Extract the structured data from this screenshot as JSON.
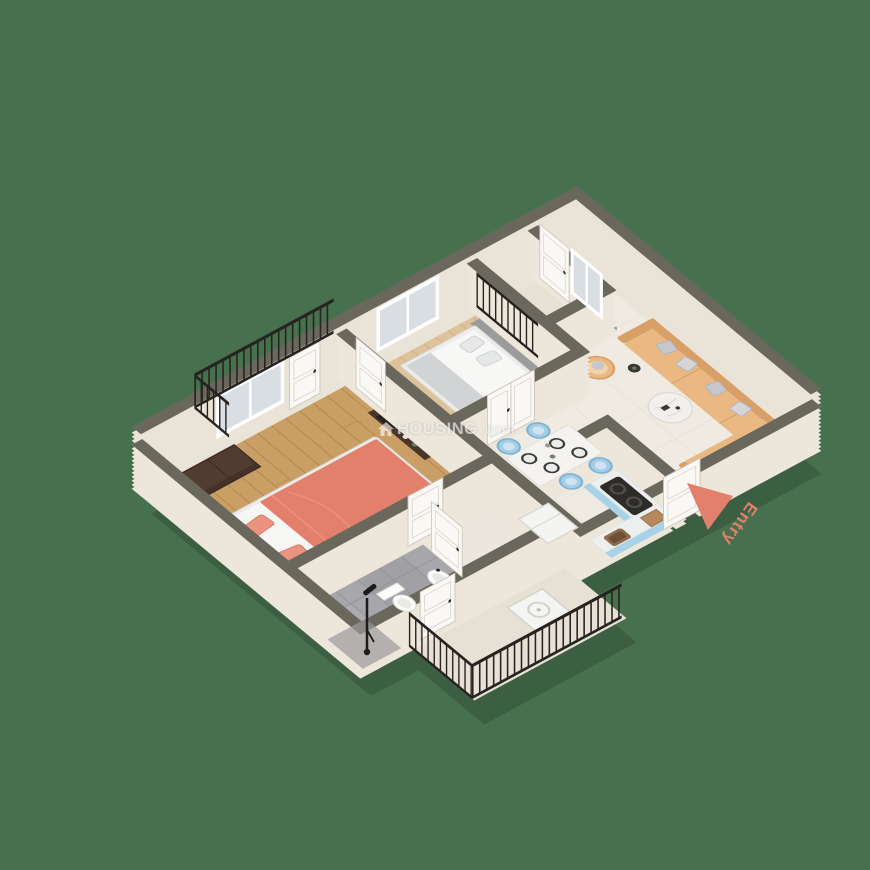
{
  "scene": {
    "description": "3D isometric render of an apartment floor plan on a green background",
    "background": "#47704E"
  },
  "entry": {
    "label": "Entry",
    "label_color": "#E4756B",
    "arrow_color": "#E8796C",
    "arrow_icon": "entry-arrow-icon"
  },
  "watermark": {
    "icon": "house-icon",
    "brand": "HOUSING",
    "tld": ".com"
  },
  "regions": [
    {
      "id": "master-bedroom",
      "floor": "wood"
    },
    {
      "id": "bedroom-2",
      "floor": "light-wood"
    },
    {
      "id": "living-room",
      "floor": "marble"
    },
    {
      "id": "dining-area",
      "floor": "marble"
    },
    {
      "id": "kitchen",
      "floor": "marble"
    },
    {
      "id": "bathroom",
      "floor": "grey-tile"
    },
    {
      "id": "hall",
      "floor": "cream"
    },
    {
      "id": "balcony-north",
      "floor": "cream"
    },
    {
      "id": "balcony-northeast",
      "floor": "cream"
    },
    {
      "id": "balcony-south",
      "floor": "cream"
    }
  ],
  "palette": {
    "bg": "#47704E",
    "wallTop": "#6A685C",
    "wallFace": "#EDE7DB",
    "wallFaceTall": "#EAE4D8",
    "floorWood": "#C99F66",
    "floorWoodLine": "#B1874F",
    "floorWood2": "#DEC29C",
    "floorWood2Line": "#CBAF85",
    "floorMarble": "#EFEBE2",
    "floorMarbleLine": "#E5E0D6",
    "floorHall": "#ECE7DD",
    "floorTile": "#A7A6AA",
    "floorTileLine": "#93929A",
    "floorBalcony": "#E7E1D5",
    "railing": "#262320",
    "doorWhite": "#FAF8F4",
    "doorShade": "#DCD6CB",
    "glass": "#D9DEE3",
    "coral": "#E2806C",
    "coralLight": "#EA9480",
    "bedFrame": "#EBECEA",
    "headboard": "#4C3931",
    "wardrobe": "#503C31",
    "wardrobeLine": "#3C2C24",
    "sofa": "#EAB983",
    "sofaDark": "#D8A066",
    "pillowGray": "#C6C7CB",
    "chairBlue": "#A5CEE6",
    "chairBlueDark": "#7FB3D4",
    "counterBlue": "#A9D2E8",
    "counterTop": "#EDEFEF",
    "applianceWhite": "#F4F4F2",
    "stoveBlack": "#2E2C2A",
    "woodItem": "#B5895C",
    "tvDark": "#4A372C",
    "grayHeadboard": "#9B9B9B"
  }
}
